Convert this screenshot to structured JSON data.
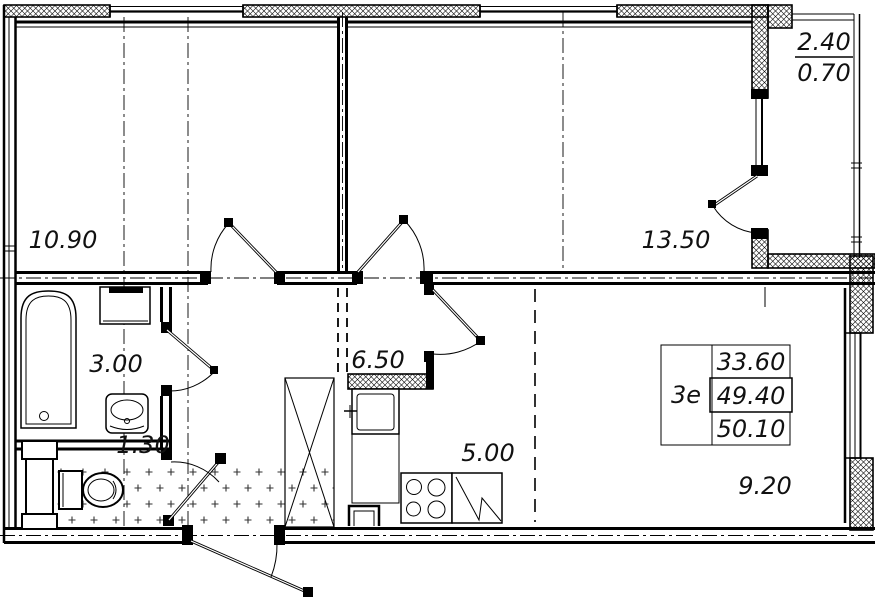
{
  "plan": {
    "rooms": [
      {
        "name": "room-1",
        "area": "10.90"
      },
      {
        "name": "room-2",
        "area": "13.50"
      },
      {
        "name": "bathroom",
        "area": "3.00"
      },
      {
        "name": "hall",
        "area": "6.50"
      },
      {
        "name": "wc",
        "area": "1.30"
      },
      {
        "name": "kitchen",
        "area": "5.00"
      },
      {
        "name": "living-kitchen",
        "area": "9.20"
      }
    ],
    "balcony": {
      "area_full": "2.40",
      "area_reduced": "0.70"
    },
    "unit_info": {
      "flat_type": "3е",
      "areas": [
        "33.60",
        "49.40",
        "50.10"
      ]
    },
    "colors": {
      "line": "#000000",
      "background": "#ffffff",
      "floor_dot": "#333333"
    }
  }
}
